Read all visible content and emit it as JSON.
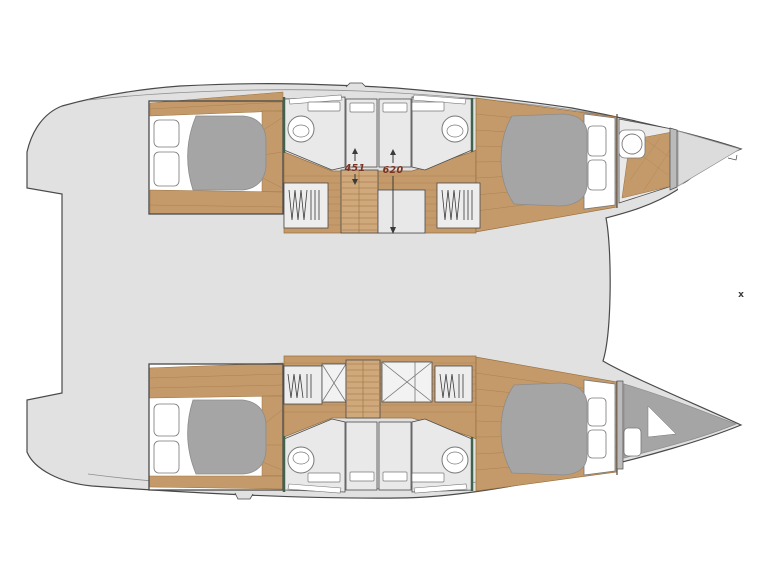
{
  "plan": {
    "type": "catamaran-interior-deck-plan",
    "dimension_labels": [
      {
        "id": "dim-451",
        "value": "451"
      },
      {
        "id": "dim-620",
        "value": "620"
      }
    ],
    "marker": "x",
    "symbols": {
      "sink-icon": "circle-basin",
      "hanging-locker-icon": "zigzag-hangers",
      "stairs-icon": "tread-lines",
      "hatch-icon": "x-cross-box",
      "bed-icon": "gray-duvet-with-pillows"
    },
    "colors": {
      "background": "#ffffff",
      "deck": "#e1e1e1",
      "deck_line": "#8f8f8f",
      "outline": "#4a4a4a",
      "wood": "#c49a6b",
      "wood_dark": "#99713f",
      "wood_light": "#cfa97c",
      "bed_gray": "#a5a5a5",
      "bed_gray_dark": "#8c8c8c",
      "head_floor": "#e9e9e9",
      "fixture": "#ffffff",
      "fixture_stroke": "#777777",
      "wall_slab": "#bbbbbb",
      "wall_green": "#41634d",
      "dim_text": "#7a3222",
      "dim_arrow": "#3a3a3a",
      "marker_color": "#3a3a3a"
    }
  }
}
